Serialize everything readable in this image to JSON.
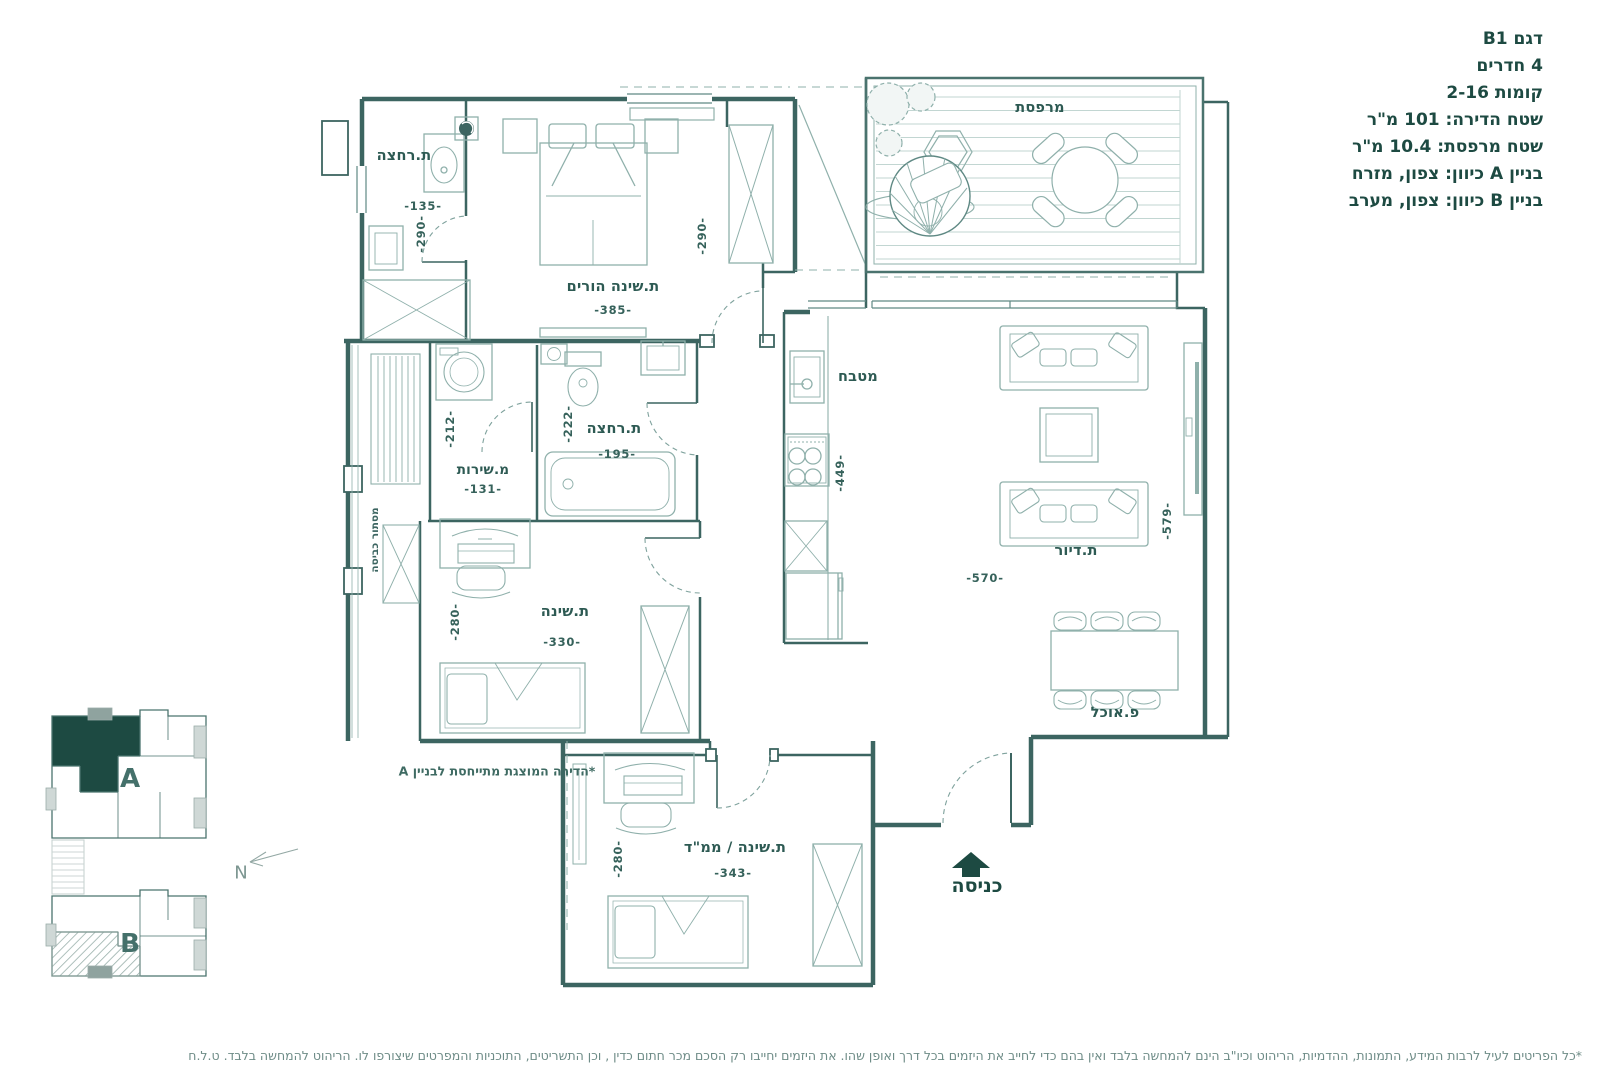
{
  "info_panel": {
    "line1": "דגם B1",
    "line2": "4 חדרים",
    "line3": "קומות 2-16",
    "line4": "שטח הדירה: 101 מ\"ר",
    "line5": "שטח מרפסת: 10.4 מ\"ר",
    "line6": "בניין A כיוון: צפון, מזרח",
    "line7": "בניין B כיוון: צפון, מערב"
  },
  "rooms": {
    "balcony": {
      "name": "מרפסת"
    },
    "bathroom_top": {
      "name": "ת.רחצה",
      "width": "-135-",
      "height": "-290-"
    },
    "master_bedroom": {
      "name": "ת.שינה הורים",
      "width": "-385-",
      "height": "-290-"
    },
    "service_room": {
      "name": "מ.שירות",
      "width": "-131-",
      "height": "-212-"
    },
    "bathroom_main": {
      "name": "ת.רחצה",
      "width": "-195-",
      "height": "-222-"
    },
    "kitchen": {
      "name": "מטבח",
      "height": "-449-"
    },
    "living_room": {
      "name": "ת.דיור",
      "width": "-570-",
      "height": "-579-"
    },
    "dining": {
      "name": "פ.אוכל"
    },
    "bedroom_middle": {
      "name": "ת.שינה",
      "width": "-330-",
      "height": "-280-"
    },
    "bedroom_mamad": {
      "name": "ת.שינה / ממ\"ד",
      "width": "-343-",
      "height": "-280-"
    },
    "laundry_screen": {
      "name": "מסתור כביסה"
    },
    "entrance": {
      "name": "כניסה"
    }
  },
  "key_plan": {
    "building_a": "A",
    "building_b": "B",
    "north": "N"
  },
  "notes": {
    "building_note": "*הדירה המוצגת מתייחסת לבניין A",
    "disclaimer": "*כל הפריטים לעיל לרבות המידע, התמונות, ההדמיות, הריהוט וכיו\"ב הינם להמחשה בלבד ואין בהם כדי לחייב את היזמים בכל דרך ואופן שהו. את היזמים יחייבו רק הסכם מכר חתום כדין , וכן התשריטים, התוכניות והמפרטים שיצורפו לו. הריהוט להמחשה בלבד. ט.ל.ח"
  },
  "colors": {
    "wall": "#3c6561",
    "mid": "#5f8984",
    "furniture": "#8fb0ab",
    "deck": "#c2d6d2",
    "accent": "#1d4a42",
    "text": "#2d5a53"
  }
}
